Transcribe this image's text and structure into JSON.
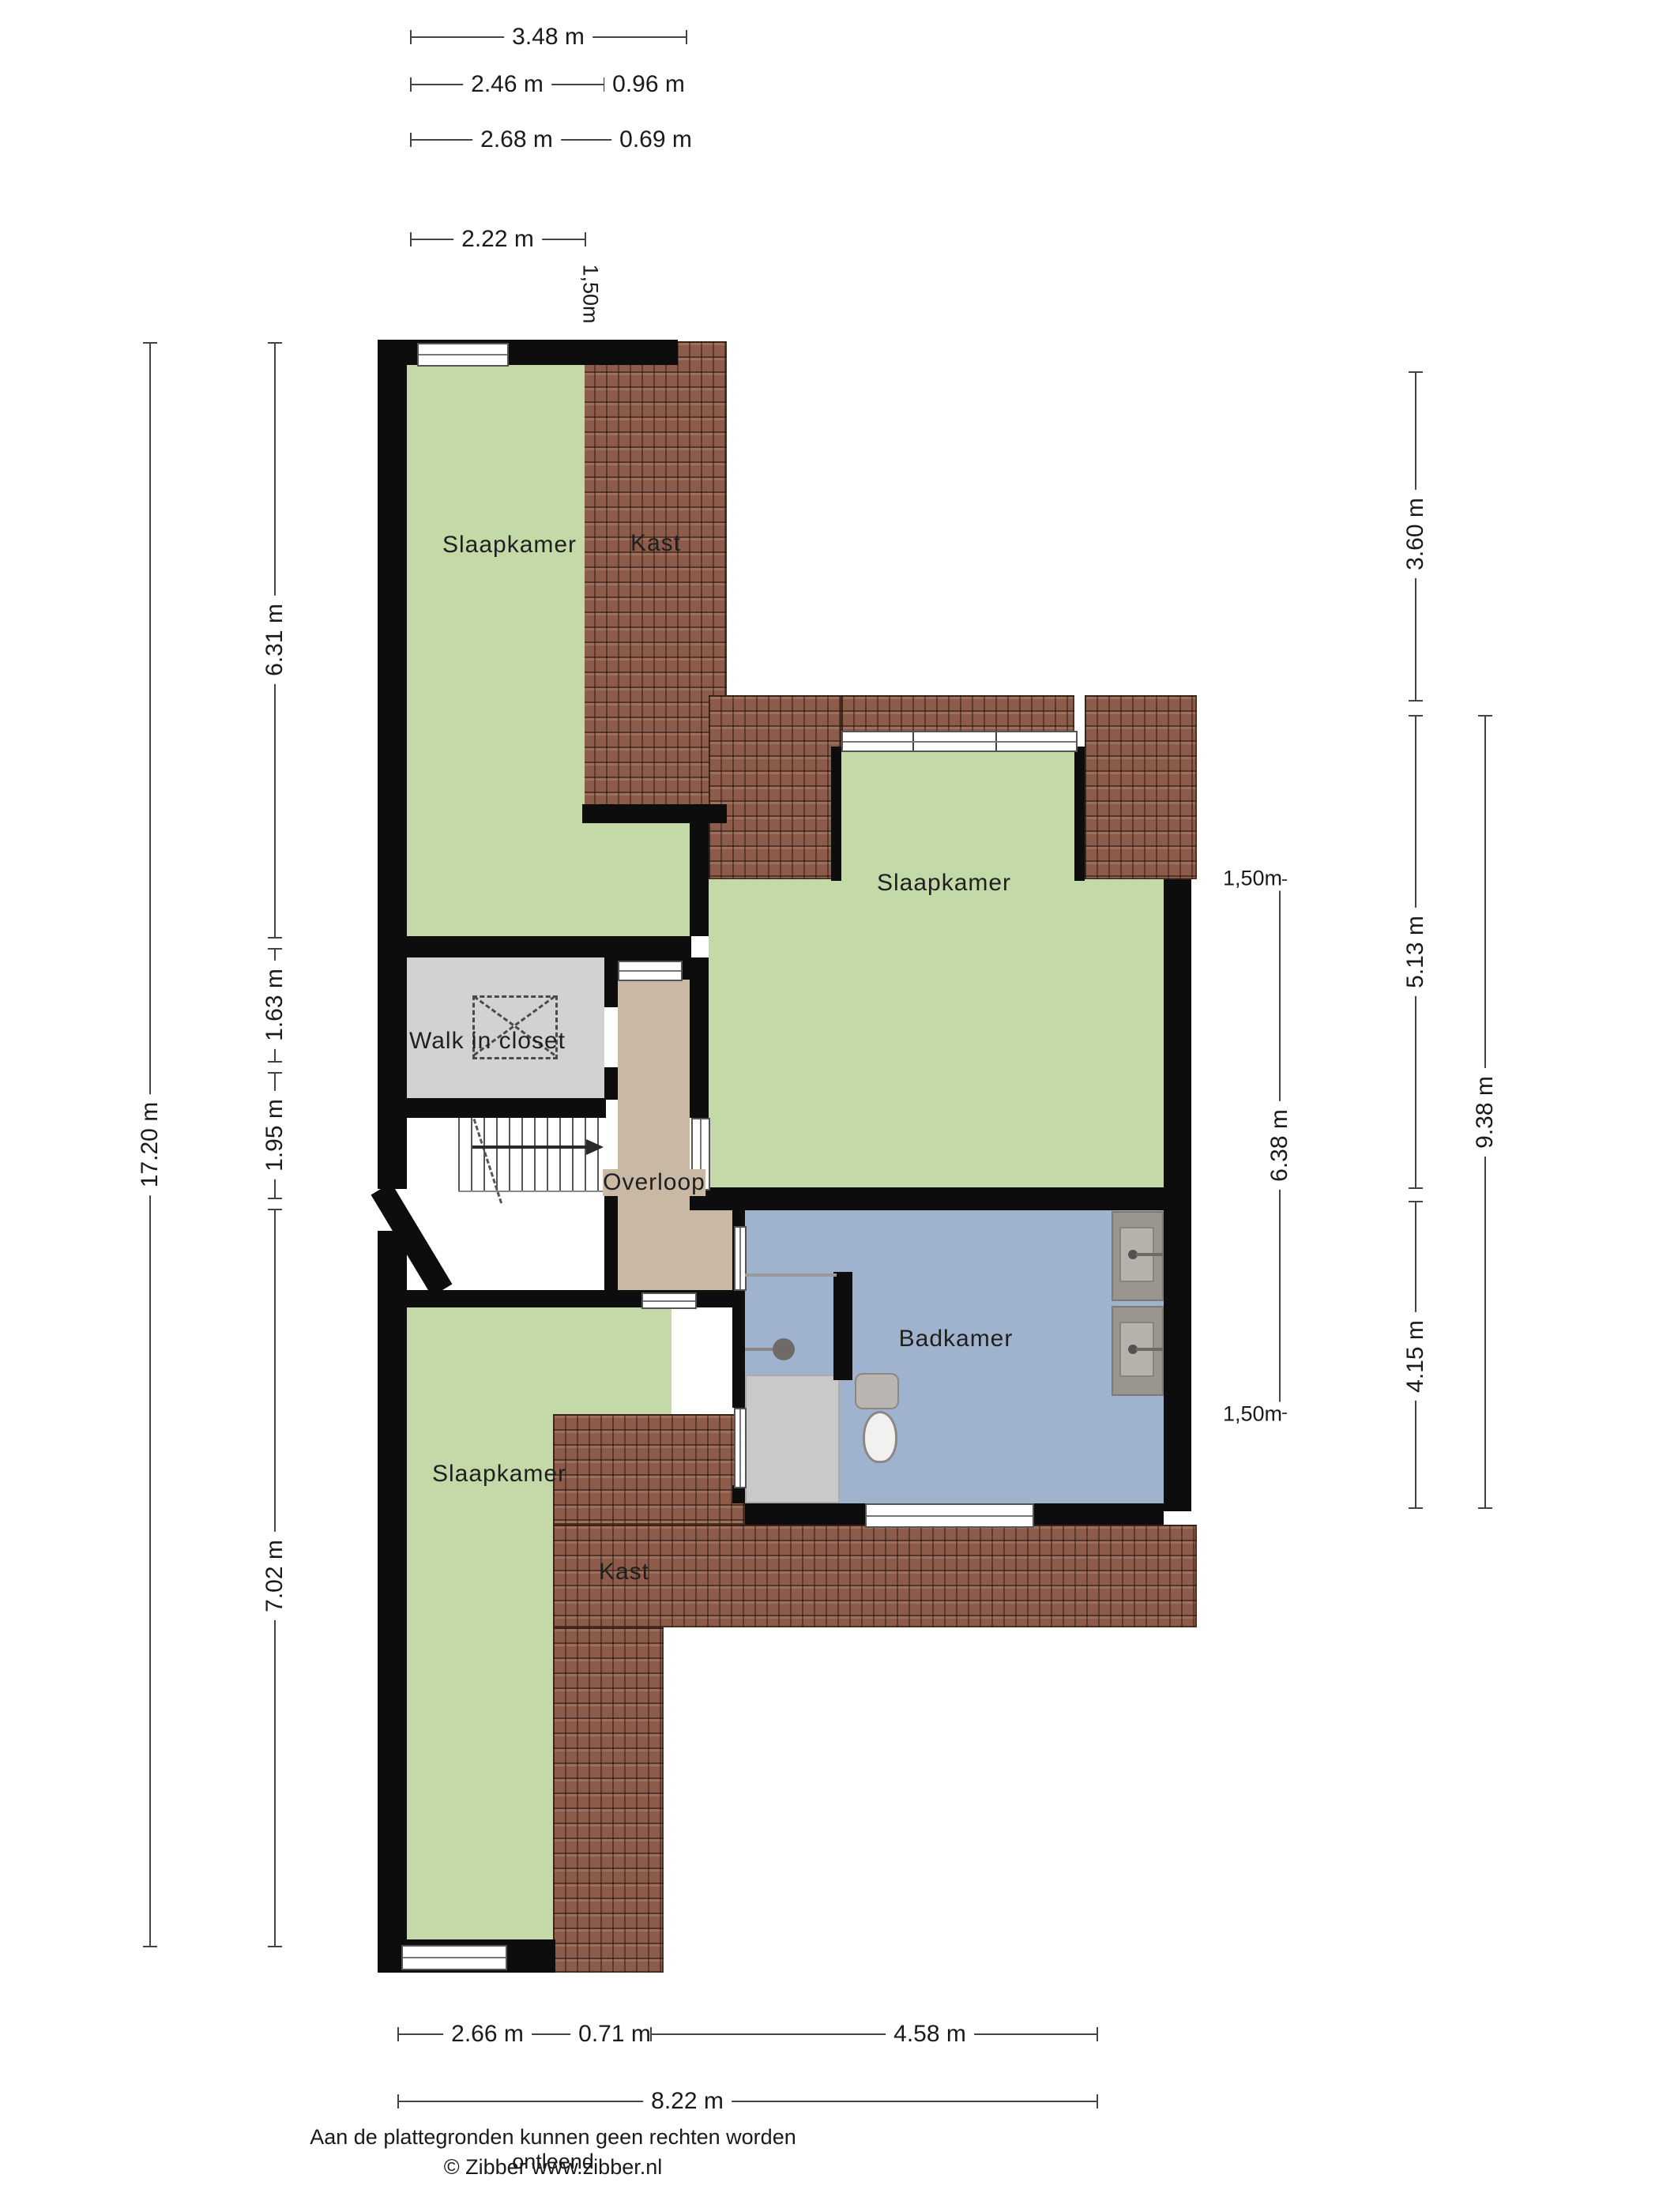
{
  "plan_type": "floorplan-second-floor",
  "rooms": {
    "slaapkamer1": "Slaapkamer",
    "kast1": "Kast",
    "slaapkamer2": "Slaapkamer",
    "walk_in_closet": "Walk in closet",
    "overloop": "Overloop",
    "badkamer": "Badkamer",
    "slaapkamer3": "Slaapkamer",
    "kast2": "Kast"
  },
  "dims": {
    "d348": "3.48 m",
    "d246": "2.46 m",
    "d096": "0.96 m",
    "d268": "2.68 m",
    "d069": "0.69 m",
    "d222": "2.22 m",
    "d150top": "1,50m",
    "d1720": "17.20 m",
    "d631": "6.31 m",
    "d163": "1.63 m",
    "d195": "1.95 m",
    "d702": "7.02 m",
    "d360": "3.60 m",
    "d513": "5.13 m",
    "d415": "4.15 m",
    "d938": "9.38 m",
    "d638": "6.38 m",
    "d150a": "1,50m",
    "d150b": "1,50m",
    "d266": "2.66 m",
    "d071": "0.71 m",
    "d458": "4.58 m",
    "d822": "8.22 m"
  },
  "footer": {
    "disclaimer": "Aan de plattegronden kunnen geen rechten worden ontleend",
    "copyright": "© Zibber www.zibber.nl"
  },
  "colors": {
    "room_green": "#c3d9a8",
    "room_blue": "#9fb3cf",
    "room_tan": "#c9b8a3",
    "room_gray": "#d2d2d2",
    "roof_brown": "#8d5b49",
    "wall_black": "#0d0d0d"
  },
  "icons": [
    "roof-tiles-pattern",
    "window-icon",
    "door-opening-icon",
    "stairs-icon",
    "stairs-direction-arrow",
    "skylight-dashed-icon",
    "shower-head-icon",
    "toilet-icon",
    "sink-icon"
  ]
}
